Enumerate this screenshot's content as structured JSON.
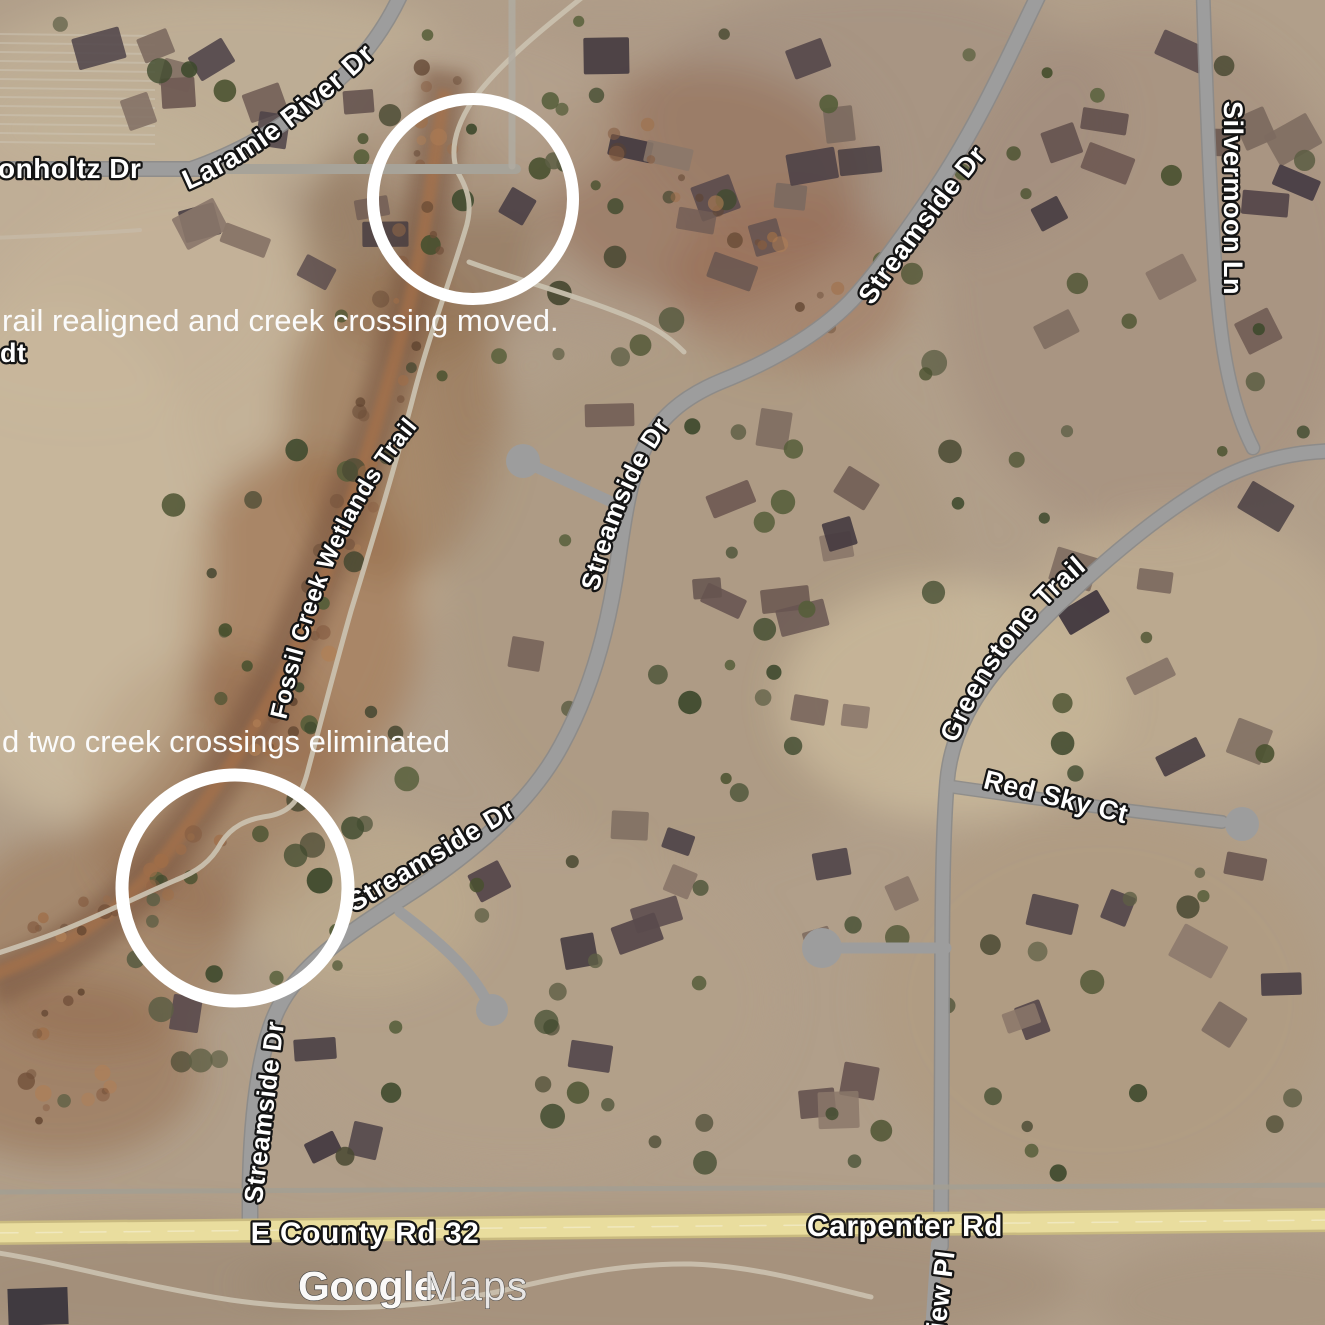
{
  "map": {
    "road_labels": [
      {
        "id": "bonholtz-dr",
        "text": "onholtz Dr"
      },
      {
        "id": "laramie-river-dr",
        "text": "Laramie River Dr"
      },
      {
        "id": "streamside-dr-top",
        "text": "Streamside Dr"
      },
      {
        "id": "silvermoon-ln",
        "text": "Silvermoon Ln"
      },
      {
        "id": "fossil-creek-wetlands-trail",
        "text": "Fossil Creek Wetlands Trail"
      },
      {
        "id": "streamside-dr-mid",
        "text": "Streamside Dr"
      },
      {
        "id": "greenstone-trail",
        "text": "Greenstone Trail"
      },
      {
        "id": "red-sky-ct",
        "text": "Red Sky Ct"
      },
      {
        "id": "streamside-dr-diagonal",
        "text": "Streamside Dr"
      },
      {
        "id": "streamside-dr-south",
        "text": "Streamside Dr"
      },
      {
        "id": "e-county-rd-32",
        "text": "E County Rd 32"
      },
      {
        "id": "carpenter-rd",
        "text": "Carpenter Rd"
      },
      {
        "id": "view-pl",
        "text": "iew Pl"
      },
      {
        "id": "cutoff-dt",
        "text": "dt"
      }
    ],
    "annotations": {
      "trail_realigned": "rail realigned and creek crossing moved.",
      "crossings_eliminated": "d two creek crossings eliminated"
    },
    "watermark": {
      "brand": "Google",
      "product": "Maps"
    },
    "colors": {
      "highlight_circle": "#ffffff",
      "street_gray": "#9d9d9d",
      "arterial_yellow": "#e9dd9e",
      "label_fill": "#ffffff",
      "label_outline": "#141414",
      "satellite_base": "#b19f8a"
    }
  }
}
